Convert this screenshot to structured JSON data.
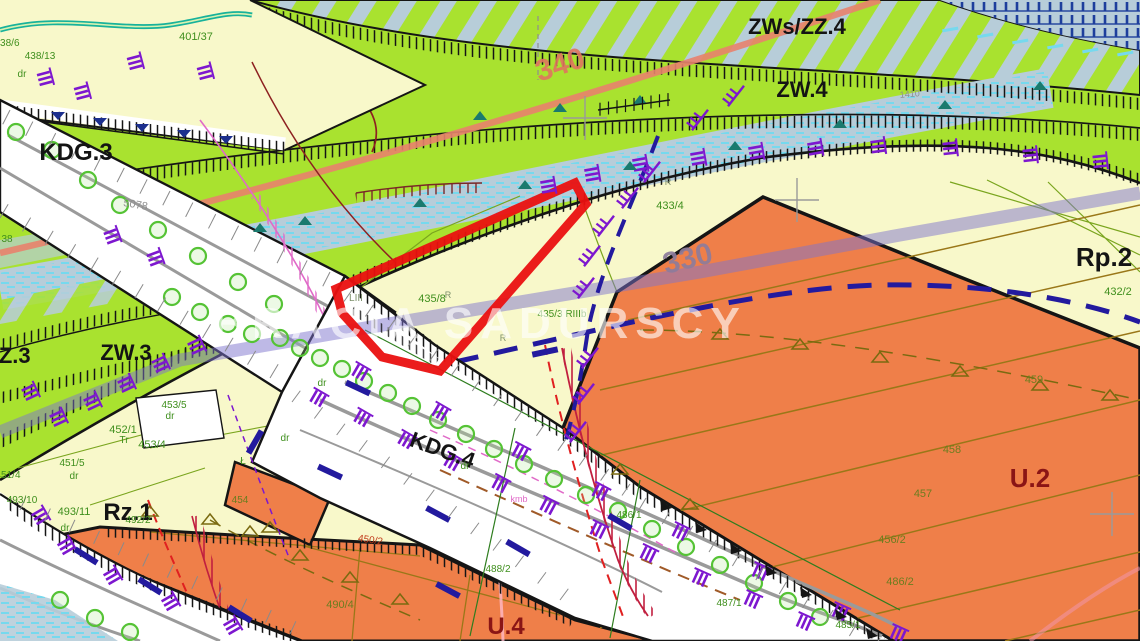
{
  "watermark": "BRACIA SADURSCY",
  "colors": {
    "background_paper": "#f8f8ca",
    "zone_green": "#a9e22f",
    "zone_bluegray": "#b7cdd9",
    "zone_orange": "#ef7f49",
    "corridor_white": "#ffffff",
    "parcel_outline_red": "#ea1010",
    "lavender_band": "#7d73c8",
    "salmon_band": "#e8826d",
    "navy_dash": "#231a9e",
    "purple_symbol": "#7d17cf",
    "crimson_line": "#c11f3f",
    "aqua_symbol": "#76d9ee",
    "tree_green": "#55c335",
    "boundary_black": "#151515",
    "label_green": "#3f8f1d",
    "label_olive": "#6b7d1f",
    "zone_label_red": "#8a1515"
  },
  "labels": [
    {
      "name": "zone-label-zws-zz4",
      "text": "ZWs/ZZ.4",
      "x": 797,
      "y": 34,
      "cls": "l-zone",
      "size": 22
    },
    {
      "name": "zone-label-zw4",
      "text": "ZW.4",
      "x": 802,
      "y": 97,
      "cls": "l-zone",
      "size": 22
    },
    {
      "name": "zone-label-kdg3",
      "text": "KDG.3",
      "x": 76,
      "y": 160,
      "cls": "l-zone",
      "size": 24
    },
    {
      "name": "zone-label-zz3",
      "text": "ZZ.3",
      "x": 8,
      "y": 363,
      "cls": "l-zone",
      "size": 22
    },
    {
      "name": "zone-label-zw3",
      "text": "ZW.3",
      "x": 126,
      "y": 360,
      "cls": "l-zone",
      "size": 22
    },
    {
      "name": "zone-label-rz1",
      "text": "Rz.1",
      "x": 128,
      "y": 520,
      "cls": "l-zone",
      "size": 24
    },
    {
      "name": "zone-label-kdg4",
      "text": "KDG.4",
      "x": 440,
      "y": 457,
      "cls": "l-zone",
      "size": 22,
      "rot": 20
    },
    {
      "name": "zone-label-u4",
      "text": "U.4",
      "x": 506,
      "y": 634,
      "cls": "l-zonered",
      "size": 24
    },
    {
      "name": "zone-label-u2",
      "text": "U.2",
      "x": 1030,
      "y": 487,
      "cls": "l-zonered",
      "size": 26
    },
    {
      "name": "zone-label-rp2",
      "text": "Rp.2",
      "x": 1104,
      "y": 266,
      "cls": "l-zone",
      "size": 26
    },
    {
      "name": "corridor-number-340",
      "text": "340",
      "x": 563,
      "y": 74,
      "cls": "l-num340",
      "size": 30,
      "rot": -18
    },
    {
      "name": "corridor-number-330",
      "text": "330",
      "x": 690,
      "y": 268,
      "cls": "l-num330",
      "size": 30,
      "rot": -14
    },
    {
      "name": "ref-number-5078",
      "text": "5078",
      "x": 135,
      "y": 208,
      "cls": "l-gray",
      "size": 11,
      "rot": 10
    },
    {
      "name": "ref-number-1410",
      "text": "1410",
      "x": 910,
      "y": 97,
      "cls": "l-gray",
      "size": 9,
      "rot": -5
    },
    {
      "name": "parcel-401-37",
      "text": "401/37",
      "x": 196,
      "y": 40,
      "cls": "l-parcel",
      "size": 11
    },
    {
      "name": "parcel-438-6",
      "text": "438/6",
      "x": 7,
      "y": 46,
      "cls": "l-parcel",
      "size": 10
    },
    {
      "name": "parcel-438-13",
      "text": "438/13",
      "x": 40,
      "y": 59,
      "cls": "l-parcel",
      "size": 10
    },
    {
      "name": "parcel-38",
      "text": "38",
      "x": 7,
      "y": 242,
      "cls": "l-parcel",
      "size": 10
    },
    {
      "name": "parcel-453-5",
      "text": "453/5",
      "x": 174,
      "y": 408,
      "cls": "l-parcel",
      "size": 10
    },
    {
      "name": "parcel-452-1",
      "text": "452/1",
      "x": 123,
      "y": 433,
      "cls": "l-parcel",
      "size": 11
    },
    {
      "name": "parcel-453-4",
      "text": "453/4",
      "x": 152,
      "y": 448,
      "cls": "l-parcel",
      "size": 11
    },
    {
      "name": "parcel-451-5",
      "text": "451/5",
      "x": 72,
      "y": 466,
      "cls": "l-parcel",
      "size": 10
    },
    {
      "name": "parcel-451-4",
      "text": "451/4",
      "x": 8,
      "y": 478,
      "cls": "l-parcel",
      "size": 10
    },
    {
      "name": "parcel-493-10",
      "text": "493/10",
      "x": 22,
      "y": 503,
      "cls": "l-parcel",
      "size": 10
    },
    {
      "name": "parcel-493-11",
      "text": "493/11",
      "x": 74,
      "y": 515,
      "cls": "l-parcel",
      "size": 11
    },
    {
      "name": "parcel-492-2",
      "text": "492/2",
      "x": 138,
      "y": 523,
      "cls": "l-parcel",
      "size": 10
    },
    {
      "name": "parcel-433-4",
      "text": "433/4",
      "x": 670,
      "y": 209,
      "cls": "l-parcel",
      "size": 11
    },
    {
      "name": "parcel-435-8",
      "text": "435/8",
      "x": 432,
      "y": 302,
      "cls": "l-parcel",
      "size": 11
    },
    {
      "name": "parcel-435-3",
      "text": "435/3 RIIIb",
      "x": 562,
      "y": 317,
      "cls": "l-parcel",
      "size": 10
    },
    {
      "name": "parcel-432-2",
      "text": "432/2",
      "x": 1118,
      "y": 295,
      "cls": "l-parcel",
      "size": 11
    },
    {
      "name": "parcel-486-1",
      "text": "486/1",
      "x": 629,
      "y": 518,
      "cls": "l-parcel",
      "size": 10
    },
    {
      "name": "parcel-487-1",
      "text": "487/1",
      "x": 729,
      "y": 606,
      "cls": "l-parcel",
      "size": 10
    },
    {
      "name": "parcel-485-1",
      "text": "485/1",
      "x": 848,
      "y": 628,
      "cls": "l-parcel",
      "size": 10
    },
    {
      "name": "parcel-488-2",
      "text": "488/2",
      "x": 498,
      "y": 572,
      "cls": "l-parcel",
      "size": 10
    },
    {
      "name": "parcel-490-4",
      "text": "490/4",
      "x": 340,
      "y": 608,
      "cls": "l-olive",
      "size": 11
    },
    {
      "name": "parcel-459",
      "text": "459",
      "x": 1034,
      "y": 383,
      "cls": "l-olive",
      "size": 11
    },
    {
      "name": "parcel-458",
      "text": "458",
      "x": 952,
      "y": 453,
      "cls": "l-olive",
      "size": 11
    },
    {
      "name": "parcel-457",
      "text": "457",
      "x": 923,
      "y": 497,
      "cls": "l-olive",
      "size": 11
    },
    {
      "name": "parcel-456-2",
      "text": "456/2",
      "x": 892,
      "y": 543,
      "cls": "l-olive",
      "size": 11
    },
    {
      "name": "parcel-486-2",
      "text": "486/2",
      "x": 900,
      "y": 585,
      "cls": "l-olive",
      "size": 11
    },
    {
      "name": "parcel-454",
      "text": "454",
      "x": 240,
      "y": 503,
      "cls": "l-olive",
      "size": 10
    },
    {
      "name": "parcel-450-2",
      "text": "450/2",
      "x": 370,
      "y": 543,
      "cls": "l-redp",
      "size": 10,
      "rot": 8
    },
    {
      "name": "road-mark-dr-1",
      "text": "dr",
      "x": 22,
      "y": 77,
      "cls": "l-parcel",
      "size": 10
    },
    {
      "name": "road-mark-dr-2",
      "text": "dr",
      "x": 170,
      "y": 419,
      "cls": "l-parcel",
      "size": 10
    },
    {
      "name": "road-mark-dr-3",
      "text": "dr",
      "x": 74,
      "y": 479,
      "cls": "l-parcel",
      "size": 10
    },
    {
      "name": "road-mark-dr-4",
      "text": "dr",
      "x": 65,
      "y": 531,
      "cls": "l-parcel",
      "size": 10
    },
    {
      "name": "road-mark-dr-5",
      "text": "dr",
      "x": 322,
      "y": 386,
      "cls": "l-parcel",
      "size": 10
    },
    {
      "name": "road-mark-dr-6",
      "text": "dr",
      "x": 285,
      "y": 441,
      "cls": "l-parcel",
      "size": 10
    },
    {
      "name": "road-mark-dr-7",
      "text": "dr",
      "x": 465,
      "y": 469,
      "cls": "l-parcel",
      "size": 10
    },
    {
      "name": "land-use-tr",
      "text": "Tr",
      "x": 124,
      "y": 443,
      "cls": "l-parcel",
      "size": 10
    },
    {
      "name": "land-use-l",
      "text": "Ł",
      "x": 243,
      "y": 464,
      "cls": "l-parcel",
      "size": 10
    },
    {
      "name": "land-use-liii",
      "text": "LIII",
      "x": 356,
      "y": 301,
      "cls": "l-liii",
      "size": 10
    },
    {
      "name": "land-use-r1",
      "text": "R",
      "x": 448,
      "y": 298,
      "cls": "l-liii",
      "size": 9
    },
    {
      "name": "land-use-r2",
      "text": "R",
      "x": 503,
      "y": 341,
      "cls": "l-liii",
      "size": 9
    },
    {
      "name": "land-use-r3",
      "text": "R",
      "x": 668,
      "y": 185,
      "cls": "l-liii",
      "size": 9
    },
    {
      "name": "note-kmb",
      "text": "kmb",
      "x": 519,
      "y": 502,
      "cls": "l-pink",
      "size": 9
    }
  ]
}
